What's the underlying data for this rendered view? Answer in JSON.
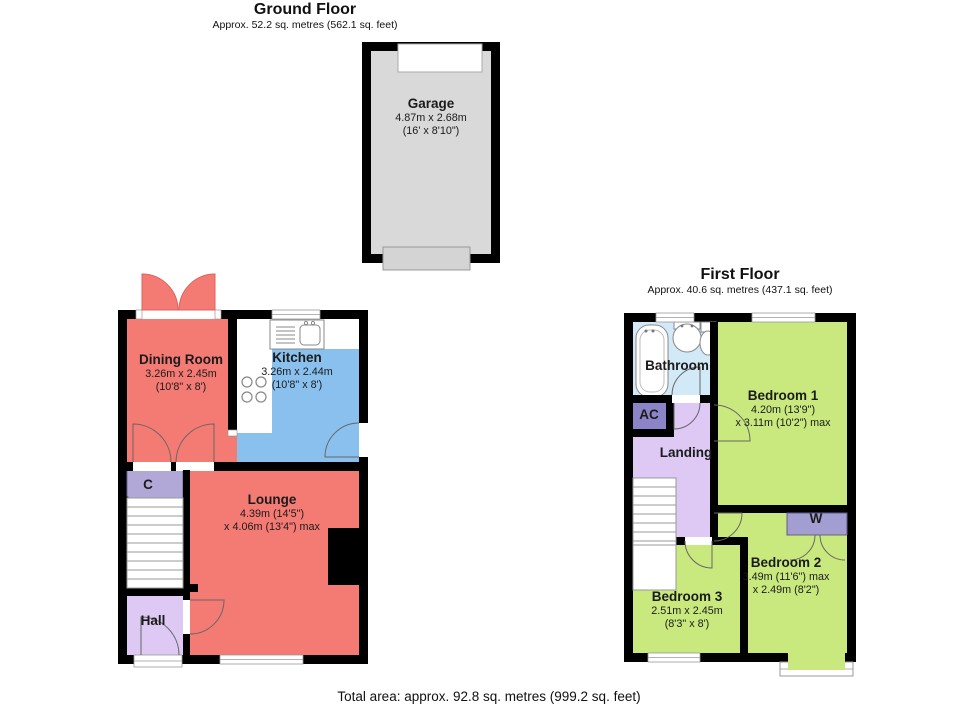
{
  "header": {
    "ground": {
      "title": "Ground Floor",
      "area": "Approx. 52.2 sq. metres (562.1 sq. feet)"
    },
    "first": {
      "title": "First Floor",
      "area": "Approx. 40.6 sq. metres (437.1 sq. feet)"
    }
  },
  "footer": {
    "total_area": "Total area: approx. 92.8 sq. metres (999.2 sq. feet)"
  },
  "rooms": {
    "garage": {
      "name": "Garage",
      "dim1": "4.87m x 2.68m",
      "dim2": "(16' x 8'10\")"
    },
    "dining": {
      "name": "Dining Room",
      "dim1": "3.26m x 2.45m",
      "dim2": "(10'8\" x 8')"
    },
    "kitchen": {
      "name": "Kitchen",
      "dim1": "3.26m x 2.44m",
      "dim2": "(10'8\" x 8')"
    },
    "lounge": {
      "name": "Lounge",
      "dim1": "4.39m (14'5\")",
      "dim2": "x 4.06m (13'4\") max"
    },
    "hall": {
      "name": "Hall"
    },
    "cupboard": {
      "name": "C"
    },
    "bathroom": {
      "name": "Bathroom"
    },
    "ac": {
      "name": "AC"
    },
    "landing": {
      "name": "Landing"
    },
    "bedroom1": {
      "name": "Bedroom 1",
      "dim1": "4.20m (13'9\")",
      "dim2": "x 3.11m (10'2\") max"
    },
    "bedroom2": {
      "name": "Bedroom 2",
      "dim1": "3.49m (11'6\") max",
      "dim2": "x 2.49m (8'2\")"
    },
    "bedroom3": {
      "name": "Bedroom 3",
      "dim1": "2.51m x 2.45m",
      "dim2": "(8'3\" x 8')"
    },
    "wardrobe": {
      "name": "W"
    }
  },
  "colors": {
    "wall": "#000000",
    "salmon": "#f47a74",
    "salmon_edge": "#e2625d",
    "kitchen_blue": "#8ac0ee",
    "bathroom_blue": "#d2e9f7",
    "green": "#c9e97e",
    "lavender": "#ddc9f3",
    "cupboard_purple": "#b2a8d8",
    "ac_purple": "#8b84c6",
    "wardrobe_purple": "#a29ed2",
    "garage_grey": "#d9d9d9",
    "garage_door_grey": "#d4d4d4"
  }
}
